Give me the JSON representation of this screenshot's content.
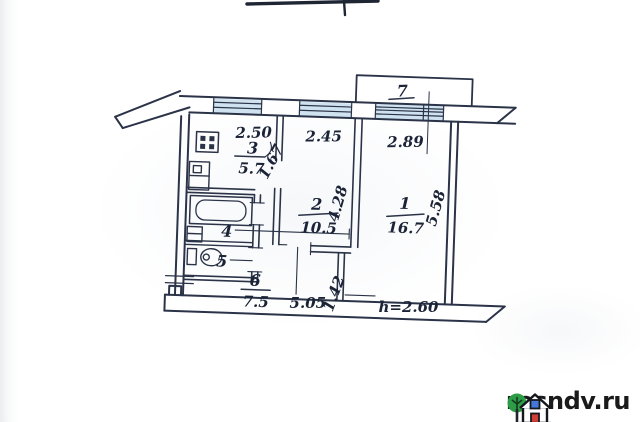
{
  "plan": {
    "ink_color": "#2b3348",
    "window_fill": "#cfe2ef",
    "rooms": [
      {
        "id": "room-1",
        "number": "1",
        "area": "16.7"
      },
      {
        "id": "room-2",
        "number": "2",
        "area": "10.5"
      },
      {
        "id": "room-3-kitchen",
        "number": "3",
        "area": "5.7"
      },
      {
        "id": "room-4-bathroom",
        "number": "4"
      },
      {
        "id": "room-5-wc",
        "number": "5"
      },
      {
        "id": "room-6-hall",
        "number": "6",
        "area": "7.5"
      },
      {
        "id": "room-7-balcony",
        "number": "7"
      }
    ],
    "dimensions": {
      "kitchen_window": "2.50",
      "room2_window": "2.45",
      "room1_window": "2.89",
      "hall_diagonal": "1.67",
      "room2_depth": "4.28",
      "room1_depth": "5.58",
      "corridor_length": "5.05",
      "corridor_depth": "1.42",
      "ceiling_height": "h=2.60"
    }
  },
  "watermark": {
    "text": "rosndv.ru",
    "tree_color": "#2d9c46",
    "window_color": "#4576d8",
    "door_color": "#cf3f33"
  }
}
